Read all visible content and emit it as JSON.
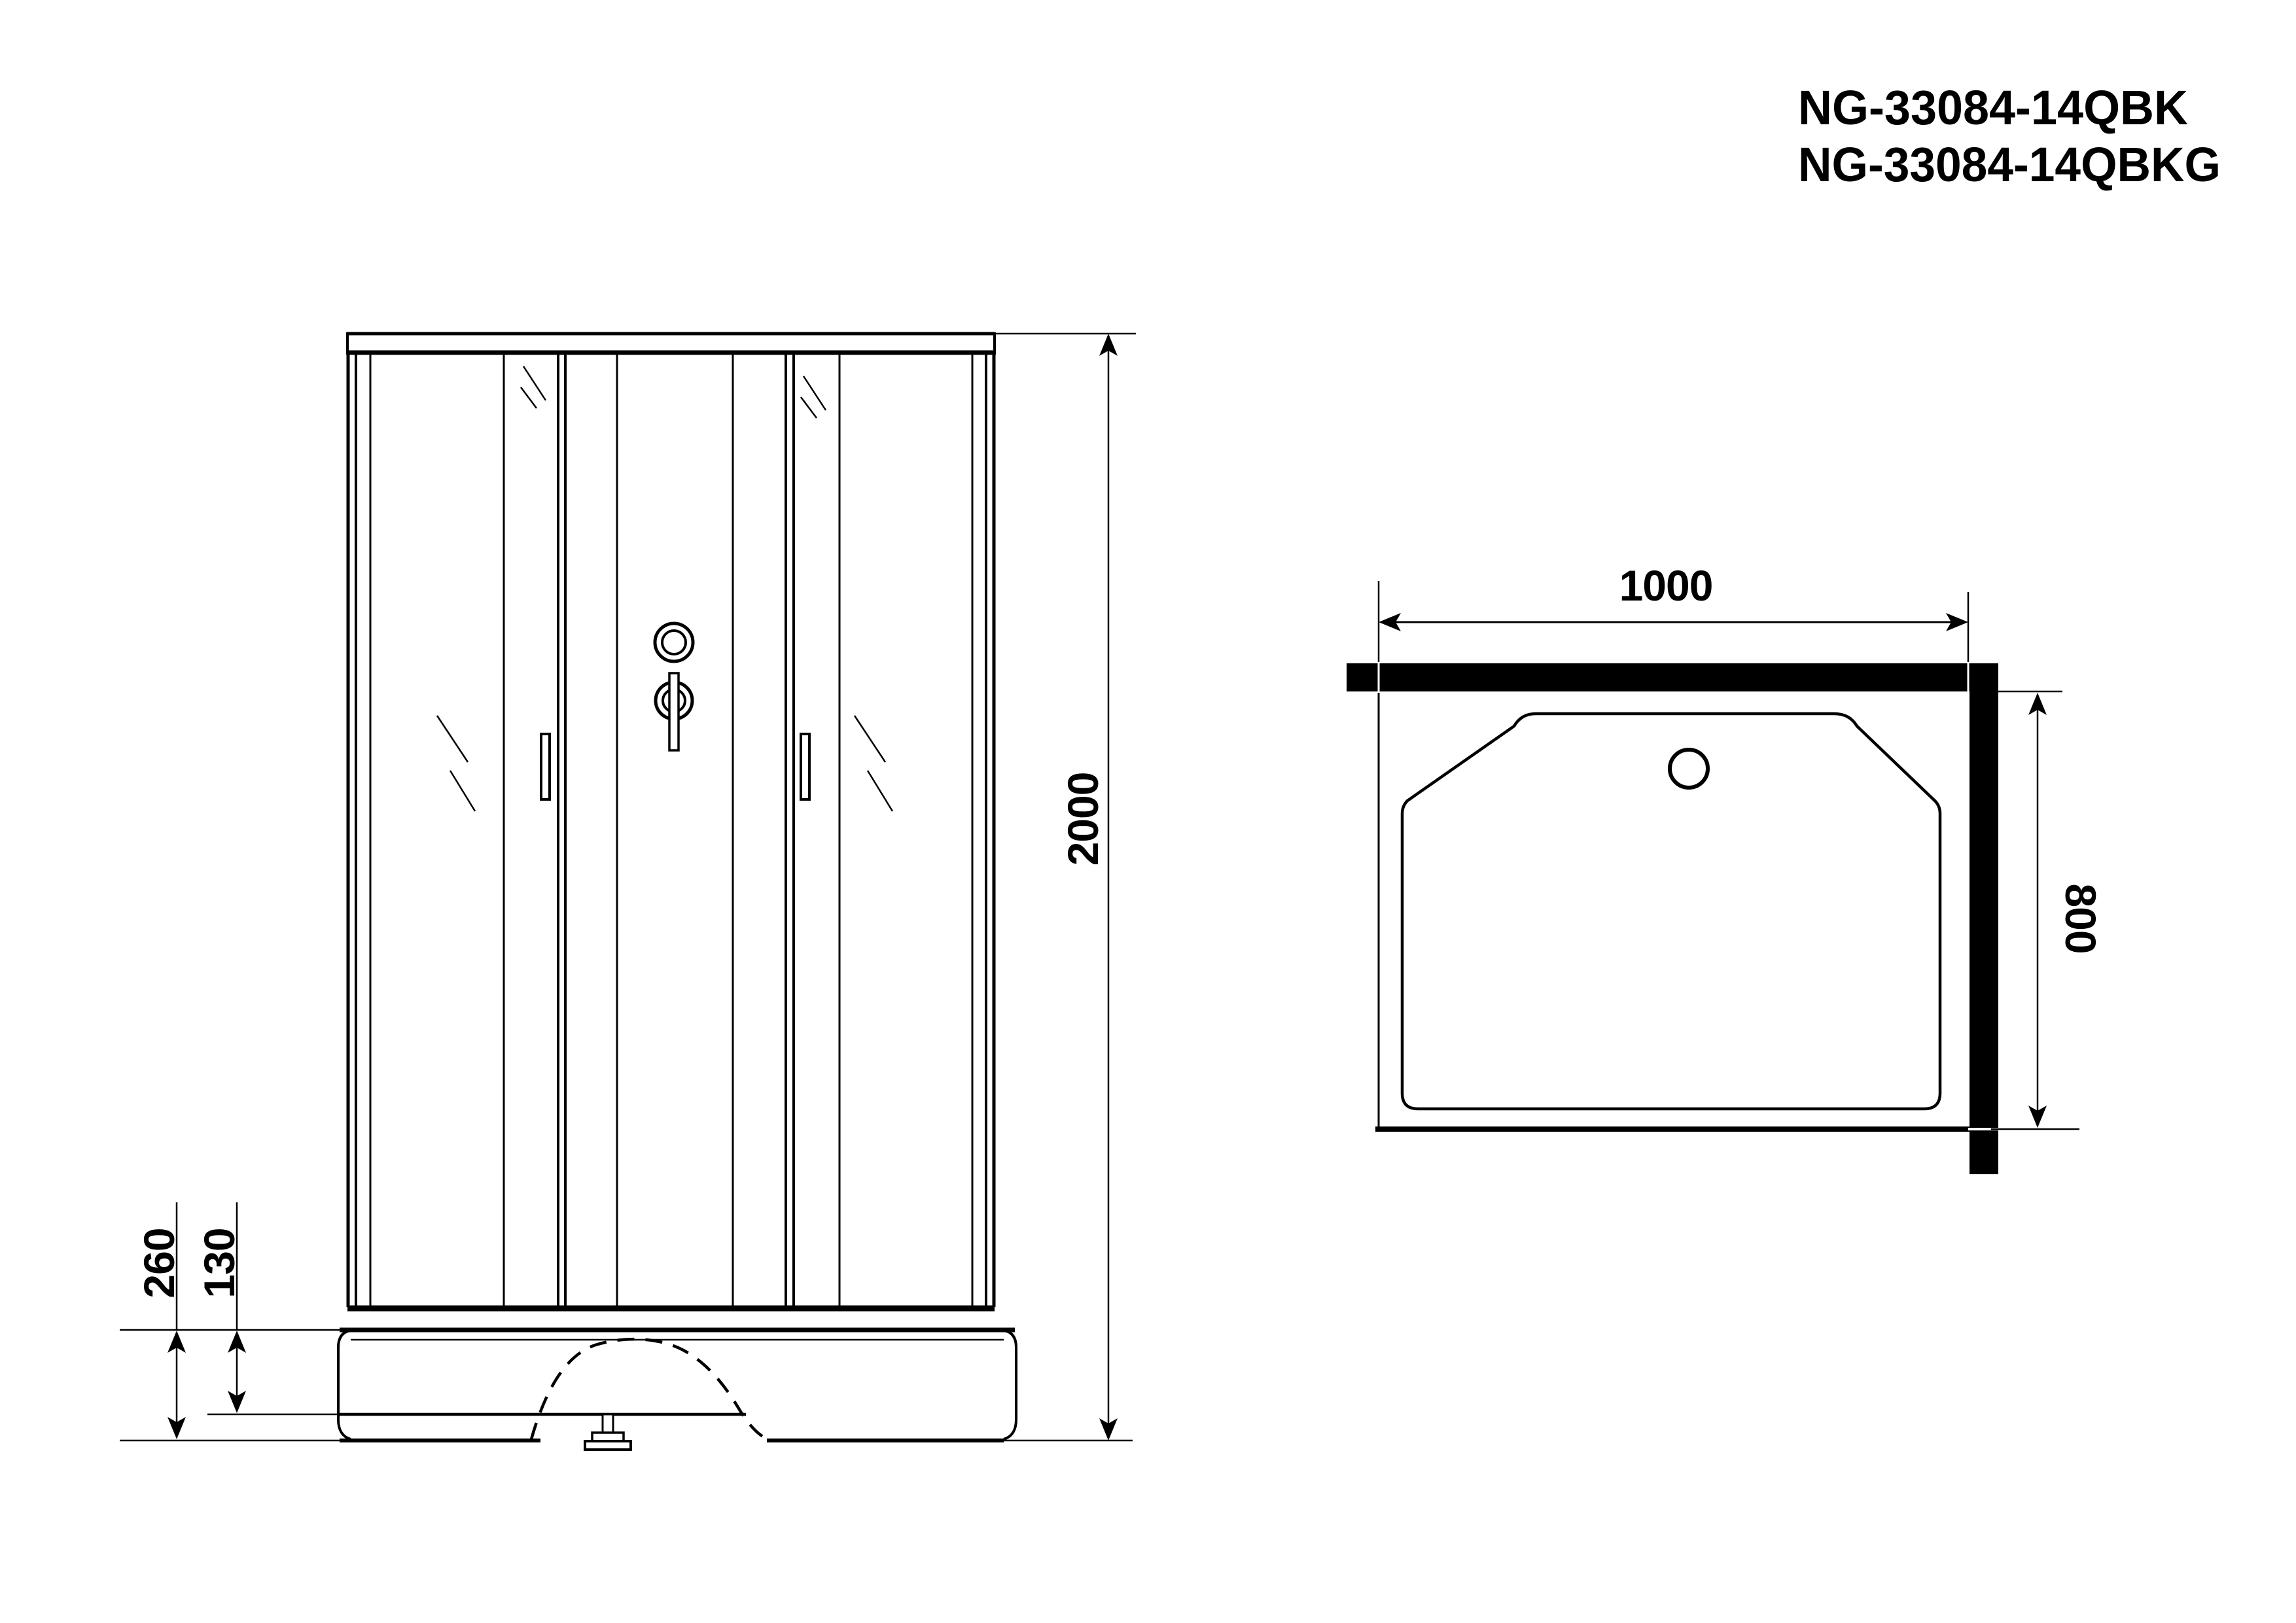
{
  "colors": {
    "ink": "#000000",
    "paper": "#ffffff"
  },
  "title_block": {
    "model_line_1": "NG-33084-14QBK",
    "model_line_2": "NG-33084-14QBKG"
  },
  "front_view": {
    "description": "front elevation of shower cabin",
    "dimensions": {
      "overall_height_mm": "2000",
      "base_height_mm": "260",
      "tray_rim_height_mm": "130"
    }
  },
  "plan_view": {
    "description": "top plan of shower tray with corner walls",
    "dimensions": {
      "overall_width_mm": "1000",
      "overall_depth_mm": "800"
    }
  }
}
